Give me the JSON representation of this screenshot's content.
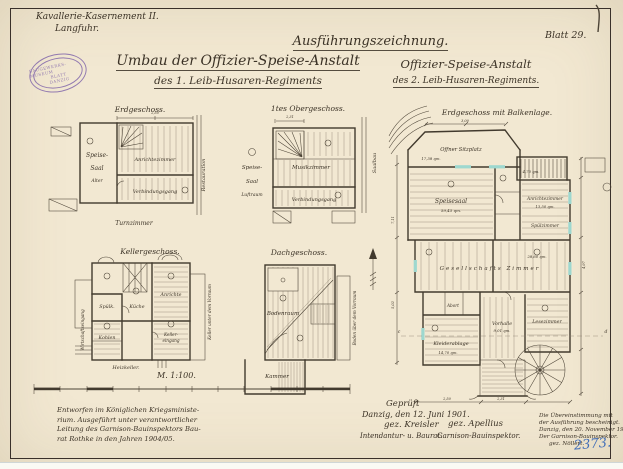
{
  "header": {
    "location_line1": "Kavallerie-Kasernement II.",
    "location_line2": "Langfuhr.",
    "title_left_line1": "Umbau der Offizier-Speise-Anstalt",
    "title_left_line2": "des 1. Leib-Husaren-Regiments",
    "title_right": "Ausführungszeichnung.",
    "subtitle_right_line1": "Offizier-Speise-Anstalt",
    "subtitle_right_line2": "des 2. Leib-Husaren-Regiments.",
    "sheet_label": "Blatt 29."
  },
  "stamp": {
    "line1": "BAUGEWERKS-MUSEUM",
    "line2": "BLATT",
    "line3": "DANZIG"
  },
  "plans": {
    "erdgeschoss": {
      "title": "Erdgeschoss.",
      "speise": "Speise-",
      "saal": "Saal",
      "alter": "Alter",
      "anrichte": "Anrichtezimmer",
      "gang": "Verbindungsgang",
      "turnzimmer": "Turnzimmer",
      "side": "Restauration"
    },
    "obergeschoss": {
      "title": "1tes Obergeschoss.",
      "speise": "Speise-",
      "saal": "Saal",
      "luftraum": "Luftraum",
      "musik": "Musikzimmer",
      "gang": "Verbindungsgang",
      "side": "Saalbau"
    },
    "keller": {
      "title": "Kellergeschoss.",
      "spuelk": "Spülk.",
      "kueche": "Küche",
      "anrichte": "Anrichte",
      "kohlen": "Kohlen",
      "keller1": "Keller-",
      "keller2": "eingang",
      "heiz": "Heizkeller.",
      "left_side": "Wirtschaftseingang",
      "right_side": "Keller unter dem Vorraum"
    },
    "dach": {
      "title": "Dachgeschoss.",
      "boden": "Bodenraum",
      "kammer": "Kammer",
      "side": "Boden über dem Vorraum"
    },
    "haupt": {
      "title": "Erdgeschoss mit Balkenlage.",
      "sitzplatz": "Offner Sitzplatz",
      "sitzplatz_qm": "17,38 qm.",
      "treppe_qm": "4,70 qm.",
      "speisesaal": "Speisesaal",
      "speisesaal_qm": "59,45 qm.",
      "anrichte": "Anrichtezimmer",
      "anrichte_qm": "13,50 qm.",
      "spuel": "Spülzimmer",
      "gesellschaft": "Gesellschafts Zimmer",
      "gesellschaft_qm": "28,60 qm.",
      "vorhalle": "Vorhalle",
      "vorhalle_qm": "9,01 qm.",
      "lese": "Lesezimmer",
      "abort": "Abort",
      "kleider": "Kleiderablage",
      "kleider_qm": "14,70 qm.",
      "marker_c": "c",
      "marker_d": "d"
    }
  },
  "dims": {
    "d1": "2,50",
    "d2": "4,97",
    "d3": "7,11",
    "d4": "2,31",
    "d5": "5,02",
    "d6": "3,00"
  },
  "scale_label": "M. 1:100.",
  "notes": {
    "line1": "Entworfen im Königlichen Kriegsministe-",
    "line2": "rium. Ausgeführt unter verantwortlicher",
    "line3": "Leitung des Garnison-Bauinspektors Bau-",
    "line4": "rat Rothke in den Jahren 1904/05."
  },
  "approval": {
    "line1": "Geprüft",
    "line2": "Danzig, den 12. Juni 1901.",
    "sig_left": "gez. Kreisler",
    "sig_right": "gez. Apellius",
    "title_left": "Intendantur- u. Baurat.",
    "title_right": "Garnison-Bauinspektor."
  },
  "certification": {
    "line1": "Die Übereinstimmung mit",
    "line2": "der Ausführung bescheinigt.",
    "line3": "Danzig, den 20. November 1905.",
    "line4": "Der Garnison-Bauinspektor.",
    "line5": "gez. Nöllert."
  },
  "archive_number": "2373."
}
